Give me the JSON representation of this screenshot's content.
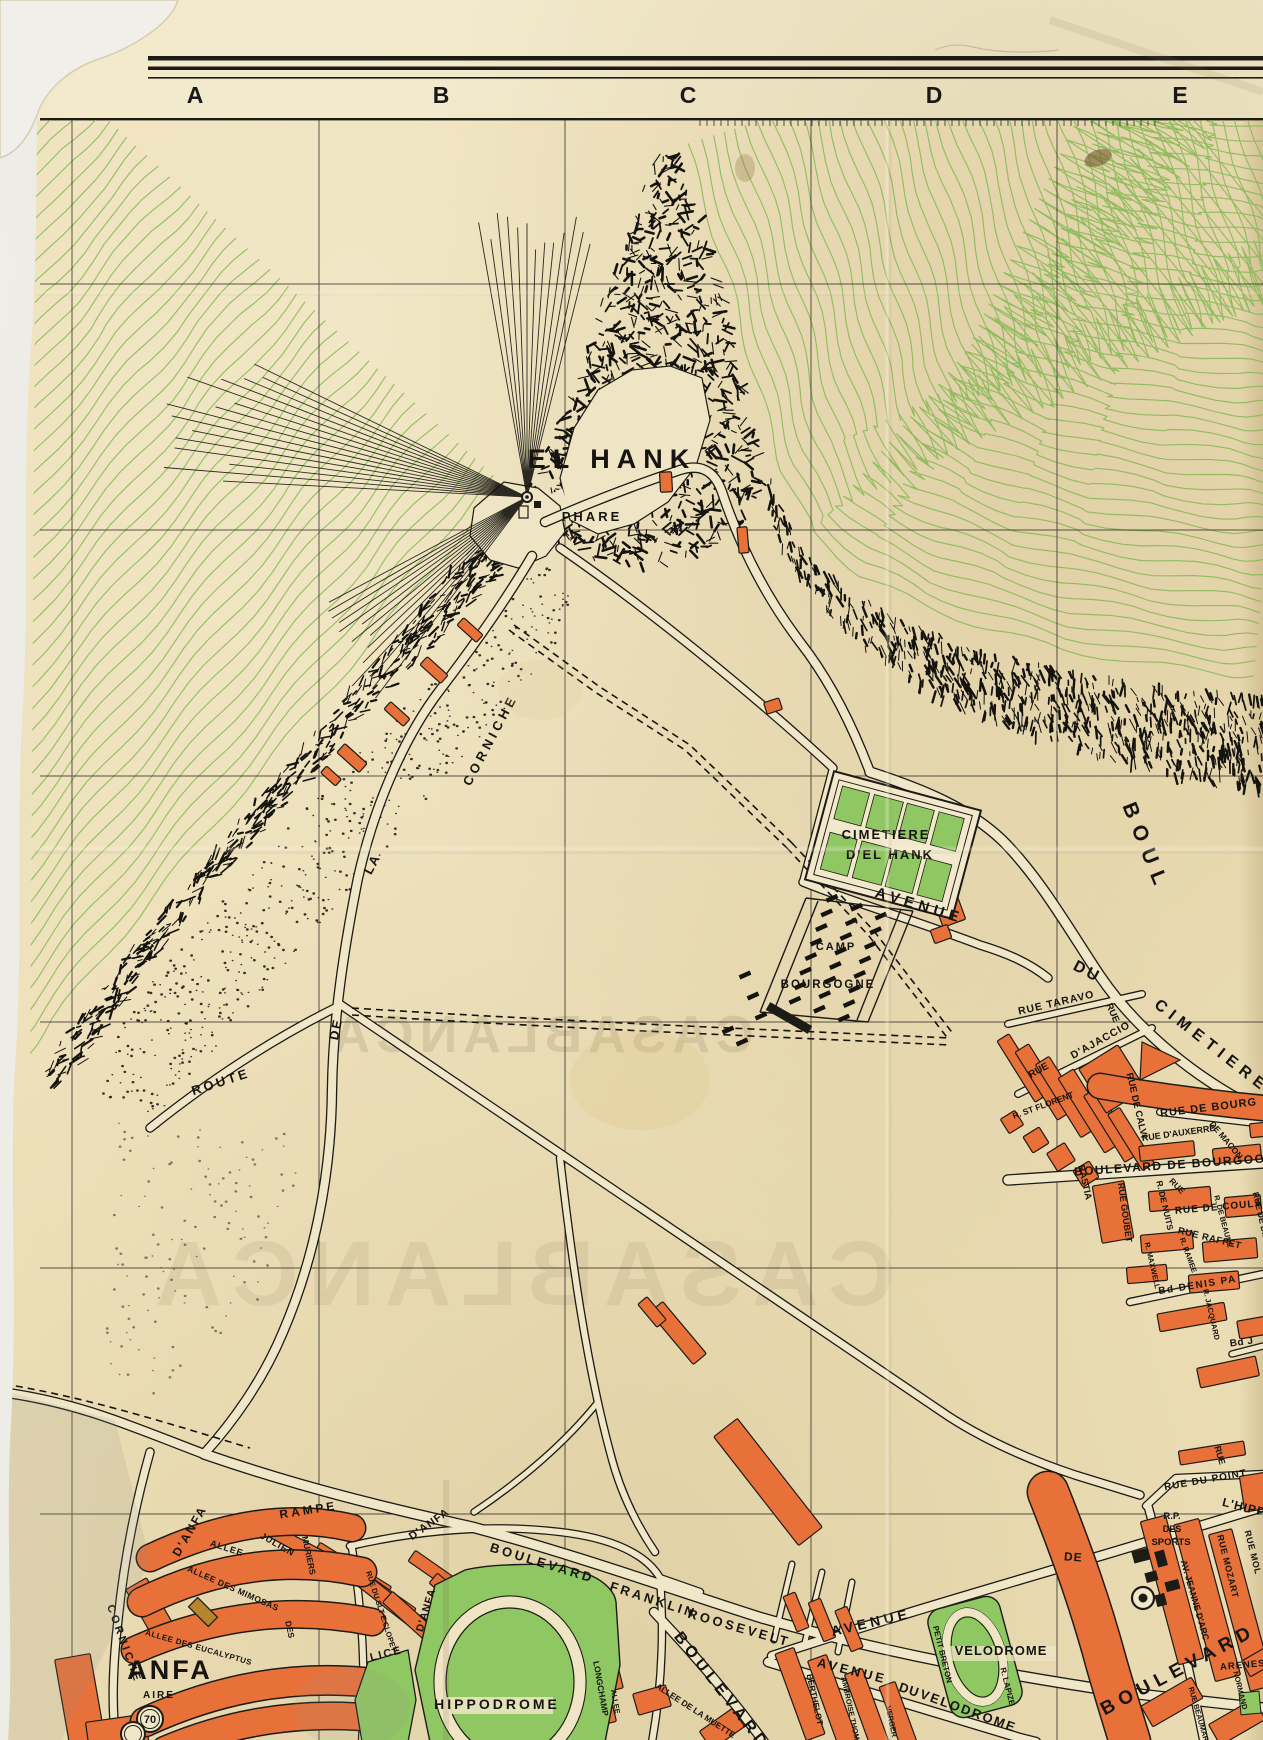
{
  "sheet": {
    "columns": [
      "A",
      "B",
      "C",
      "D",
      "E"
    ]
  },
  "colors": {
    "paper": "#ecdeb6",
    "paperLight": "#f1e8c8",
    "road": "#f0e7c8",
    "ink": "#1d1b16",
    "orange": "#e8713a",
    "green": "#8fc763",
    "contour": "#7db54e",
    "ghost": "#b3a27e"
  },
  "labels": [
    {
      "t": "EL HANK",
      "x": 612,
      "y": 468,
      "r": 0,
      "s": 27,
      "ls": 7
    },
    {
      "t": "PHARE",
      "x": 592,
      "y": 521,
      "r": 0,
      "s": 13,
      "ls": 3
    },
    {
      "t": "CIMETIERE",
      "x": 886,
      "y": 839,
      "r": 0,
      "s": 13,
      "ls": 2
    },
    {
      "t": "D'EL HANK",
      "x": 890,
      "y": 859,
      "r": 0,
      "s": 13,
      "ls": 2
    },
    {
      "t": "AVENUE",
      "x": 918,
      "y": 910,
      "r": 17,
      "s": 15,
      "ls": 5
    },
    {
      "t": "CAMP",
      "x": 836,
      "y": 950,
      "r": 0,
      "s": 11,
      "ls": 2
    },
    {
      "t": "BOURGOGNE",
      "x": 828,
      "y": 988,
      "r": 0,
      "s": 11.5,
      "ls": 2
    },
    {
      "t": "CORNICHE",
      "x": 494,
      "y": 742,
      "r": -62,
      "s": 13,
      "ls": 4
    },
    {
      "t": "LA",
      "x": 376,
      "y": 866,
      "r": -62,
      "s": 13,
      "ls": 2
    },
    {
      "t": "DE",
      "x": 340,
      "y": 1030,
      "r": -78,
      "s": 13,
      "ls": 2
    },
    {
      "t": "ROUTE",
      "x": 222,
      "y": 1086,
      "r": -18,
      "s": 13,
      "ls": 3
    },
    {
      "t": "BOUL",
      "x": 1140,
      "y": 850,
      "r": 68,
      "s": 21,
      "ls": 9
    },
    {
      "t": "DU",
      "x": 1085,
      "y": 976,
      "r": 28,
      "s": 16,
      "ls": 3
    },
    {
      "t": "CIMETIERE",
      "x": 1209,
      "y": 1050,
      "r": 38,
      "s": 16,
      "ls": 6
    },
    {
      "t": "RUE TARAVO",
      "x": 1057,
      "y": 1006,
      "r": -13,
      "s": 10.5,
      "ls": 1
    },
    {
      "t": "RUE",
      "x": 1110,
      "y": 1014,
      "r": 66,
      "s": 9.5,
      "ls": 0
    },
    {
      "t": "RUE",
      "x": 1040,
      "y": 1073,
      "r": -29,
      "s": 10,
      "ls": 0
    },
    {
      "t": "D'AJACCIO",
      "x": 1102,
      "y": 1043,
      "r": -29,
      "s": 10.5,
      "ls": 1
    },
    {
      "t": "RUE DE CALVI",
      "x": 1134,
      "y": 1106,
      "r": 77,
      "s": 9.5,
      "ls": 0
    },
    {
      "t": "R. ST FLORENT",
      "x": 1044,
      "y": 1108,
      "r": -20,
      "s": 8.5,
      "ls": 0
    },
    {
      "t": "BASTIA",
      "x": 1082,
      "y": 1183,
      "r": 77,
      "s": 9.5,
      "ls": 0
    },
    {
      "t": "RUE DE BOURG",
      "x": 1209,
      "y": 1111,
      "r": -7,
      "s": 11,
      "ls": 1
    },
    {
      "t": "RUE D'AUXERRE",
      "x": 1179,
      "y": 1136,
      "r": -8,
      "s": 9,
      "ls": 0
    },
    {
      "t": "DE MACON",
      "x": 1224,
      "y": 1142,
      "r": 50,
      "s": 8.5,
      "ls": 0
    },
    {
      "t": "BOULEVARD DE BOURGOG",
      "x": 1170,
      "y": 1169,
      "r": -4,
      "s": 12,
      "ls": 1.5
    },
    {
      "t": "RUE GOUBET",
      "x": 1122,
      "y": 1213,
      "r": 82,
      "s": 9,
      "ls": 0
    },
    {
      "t": "R. DE NUITS",
      "x": 1162,
      "y": 1206,
      "r": 77,
      "s": 8.5,
      "ls": 0
    },
    {
      "t": "RUE",
      "x": 1175,
      "y": 1188,
      "r": 45,
      "s": 8.5,
      "ls": 0
    },
    {
      "t": "RUE DE COULA",
      "x": 1219,
      "y": 1210,
      "r": -5,
      "s": 10,
      "ls": 1
    },
    {
      "t": "RUE RAFFET",
      "x": 1209,
      "y": 1241,
      "r": 14,
      "s": 9.5,
      "ls": 0.5
    },
    {
      "t": "R. DE BEAUNE",
      "x": 1221,
      "y": 1222,
      "r": 75,
      "s": 7.5,
      "ls": 0
    },
    {
      "t": "RUE DE DIJ",
      "x": 1258,
      "y": 1216,
      "r": 77,
      "s": 8.5,
      "ls": 0
    },
    {
      "t": "R. RAMEE",
      "x": 1186,
      "y": 1256,
      "r": 70,
      "s": 7.5,
      "ls": 0
    },
    {
      "t": "R. MAXWELL",
      "x": 1150,
      "y": 1266,
      "r": 77,
      "s": 7.5,
      "ls": 0
    },
    {
      "t": "Bd DENIS PA",
      "x": 1198,
      "y": 1288,
      "r": -9,
      "s": 10,
      "ls": 1.5
    },
    {
      "t": "R. JACQUARD",
      "x": 1209,
      "y": 1315,
      "r": 77,
      "s": 7.5,
      "ls": 0
    },
    {
      "t": "Bd J",
      "x": 1242,
      "y": 1345,
      "r": -8,
      "s": 10,
      "ls": 0.5
    },
    {
      "t": "RUE",
      "x": 1217,
      "y": 1456,
      "r": 74,
      "s": 9,
      "ls": 0
    },
    {
      "t": "RUE DU POINT",
      "x": 1206,
      "y": 1483,
      "r": -10,
      "s": 10,
      "ls": 1
    },
    {
      "t": "R.P.",
      "x": 1172,
      "y": 1519,
      "r": 0,
      "s": 9.5,
      "ls": 0
    },
    {
      "t": "DES",
      "x": 1172,
      "y": 1532,
      "r": 0,
      "s": 9,
      "ls": 0
    },
    {
      "t": "SPORTS",
      "x": 1171,
      "y": 1545,
      "r": 0,
      "s": 9.5,
      "ls": 0
    },
    {
      "t": "L'HIPP",
      "x": 1243,
      "y": 1511,
      "r": 14,
      "s": 12,
      "ls": 1
    },
    {
      "t": "DE",
      "x": 1073,
      "y": 1561,
      "r": 4,
      "s": 12,
      "ls": 1
    },
    {
      "t": "AV. JEANNE D'ARC",
      "x": 1192,
      "y": 1601,
      "r": 74,
      "s": 9,
      "ls": 0
    },
    {
      "t": "RUE MOZART",
      "x": 1225,
      "y": 1567,
      "r": 76,
      "s": 9,
      "ls": 0.5
    },
    {
      "t": "RUE MOL",
      "x": 1250,
      "y": 1553,
      "r": 76,
      "s": 9,
      "ls": 0.5
    },
    {
      "t": "BOULEVARD",
      "x": 1181,
      "y": 1675,
      "r": -28,
      "s": 19,
      "ls": 6
    },
    {
      "t": "ARENES",
      "x": 1243,
      "y": 1668,
      "r": -5,
      "s": 9.5,
      "ls": 1
    },
    {
      "t": "NORMAND",
      "x": 1238,
      "y": 1691,
      "r": 76,
      "s": 7.5,
      "ls": 0
    },
    {
      "t": "RUE BEAUMARCH.",
      "x": 1198,
      "y": 1721,
      "r": 74,
      "s": 7.5,
      "ls": 0
    },
    {
      "t": "VELODROME",
      "x": 1001,
      "y": 1655,
      "r": 0,
      "s": 13,
      "ls": 1
    },
    {
      "t": "PETIT BRETON",
      "x": 940,
      "y": 1655,
      "r": 76,
      "s": 8,
      "ls": 0
    },
    {
      "t": "R. LAPIZE",
      "x": 1005,
      "y": 1687,
      "r": 76,
      "s": 8,
      "ls": 0
    },
    {
      "t": "AVENUE",
      "x": 872,
      "y": 1627,
      "r": -13,
      "s": 14,
      "ls": 4
    },
    {
      "t": "AVENUE",
      "x": 851,
      "y": 1675,
      "r": 14,
      "s": 13,
      "ls": 3
    },
    {
      "t": "DU",
      "x": 908,
      "y": 1694,
      "r": 18,
      "s": 13,
      "ls": 1
    },
    {
      "t": "VELODROME",
      "x": 967,
      "y": 1715,
      "r": 20,
      "s": 13,
      "ls": 2
    },
    {
      "t": "BOULEVARD",
      "x": 541,
      "y": 1567,
      "r": 17,
      "s": 13,
      "ls": 3
    },
    {
      "t": "FRANKLIN",
      "x": 652,
      "y": 1604,
      "r": 18,
      "s": 13,
      "ls": 3
    },
    {
      "t": "ROOSEVELT",
      "x": 738,
      "y": 1632,
      "r": 16,
      "s": 13,
      "ls": 3
    },
    {
      "t": "BOULEVARD",
      "x": 718,
      "y": 1694,
      "r": 52,
      "s": 16,
      "ls": 5
    },
    {
      "t": "ALLEE",
      "x": 613,
      "y": 1702,
      "r": 80,
      "s": 7.5,
      "ls": 0
    },
    {
      "t": "LONGCHAMP",
      "x": 598,
      "y": 1689,
      "r": 80,
      "s": 8.5,
      "ls": 0
    },
    {
      "t": "ALLEE DE LA MUETTE",
      "x": 694,
      "y": 1713,
      "r": 33,
      "s": 8.5,
      "ls": 0
    },
    {
      "t": "BERTHELOT",
      "x": 812,
      "y": 1700,
      "r": 78,
      "s": 8.5,
      "ls": 0
    },
    {
      "t": "AMBROISE THOMAS",
      "x": 849,
      "y": 1714,
      "r": 78,
      "s": 7.5,
      "ls": 0
    },
    {
      "t": "VERGER",
      "x": 889,
      "y": 1722,
      "r": 78,
      "s": 7.5,
      "ls": 0
    },
    {
      "t": "HIPPODROME",
      "x": 497,
      "y": 1709,
      "r": 0,
      "s": 14,
      "ls": 3
    },
    {
      "t": "LICE",
      "x": 387,
      "y": 1657,
      "r": -14,
      "s": 11,
      "ls": 2
    },
    {
      "t": "D'ANFA",
      "x": 429,
      "y": 1611,
      "r": -73,
      "s": 10.5,
      "ls": 1
    },
    {
      "t": "RUE DU SLT E.CLOPET",
      "x": 379,
      "y": 1612,
      "r": 72,
      "s": 7.5,
      "ls": 0
    },
    {
      "t": "RAMPE",
      "x": 309,
      "y": 1514,
      "r": -9,
      "s": 12,
      "ls": 3
    },
    {
      "t": "D'ANFA",
      "x": 193,
      "y": 1533,
      "r": -60,
      "s": 12,
      "ls": 2
    },
    {
      "t": "D'ANFA",
      "x": 431,
      "y": 1527,
      "r": -35,
      "s": 11,
      "ls": 1
    },
    {
      "t": "ALLEE",
      "x": 226,
      "y": 1551,
      "r": 18,
      "s": 9,
      "ls": 1
    },
    {
      "t": "JULIEN",
      "x": 276,
      "y": 1547,
      "r": 30,
      "s": 9,
      "ls": 1
    },
    {
      "t": "MURIERS",
      "x": 306,
      "y": 1556,
      "r": 78,
      "s": 8.5,
      "ls": 0
    },
    {
      "t": "DES",
      "x": 287,
      "y": 1630,
      "r": 78,
      "s": 8.5,
      "ls": 0
    },
    {
      "t": "ALLEE DES MIMOSAS",
      "x": 232,
      "y": 1591,
      "r": 24,
      "s": 8.5,
      "ls": 0.5
    },
    {
      "t": "ALLEE DES EUCALYPTUS",
      "x": 198,
      "y": 1650,
      "r": 16,
      "s": 8,
      "ls": 0.5
    },
    {
      "t": "ANFA",
      "x": 170,
      "y": 1679,
      "r": 0,
      "s": 27,
      "ls": 3
    },
    {
      "t": "AIRE",
      "x": 159,
      "y": 1698,
      "r": 0,
      "s": 10,
      "ls": 2
    },
    {
      "t": "CORNICHE",
      "x": 121,
      "y": 1645,
      "r": 70,
      "s": 11,
      "ls": 3
    }
  ],
  "roundels": [
    {
      "t": "70",
      "x": 150,
      "y": 1719,
      "r": 13
    },
    {
      "t": "",
      "x": 133,
      "y": 1734,
      "r": 12
    }
  ],
  "targets": [
    {
      "x": 1143,
      "y": 1598
    }
  ],
  "ghosts": [
    {
      "t": "CASABLANCA",
      "x": 540,
      "y": 1052,
      "s": 52,
      "ls": 6,
      "o": 0.35
    },
    {
      "t": "CASABLANCA",
      "x": 520,
      "y": 1305,
      "s": 92,
      "ls": 10,
      "o": 0.22
    }
  ]
}
